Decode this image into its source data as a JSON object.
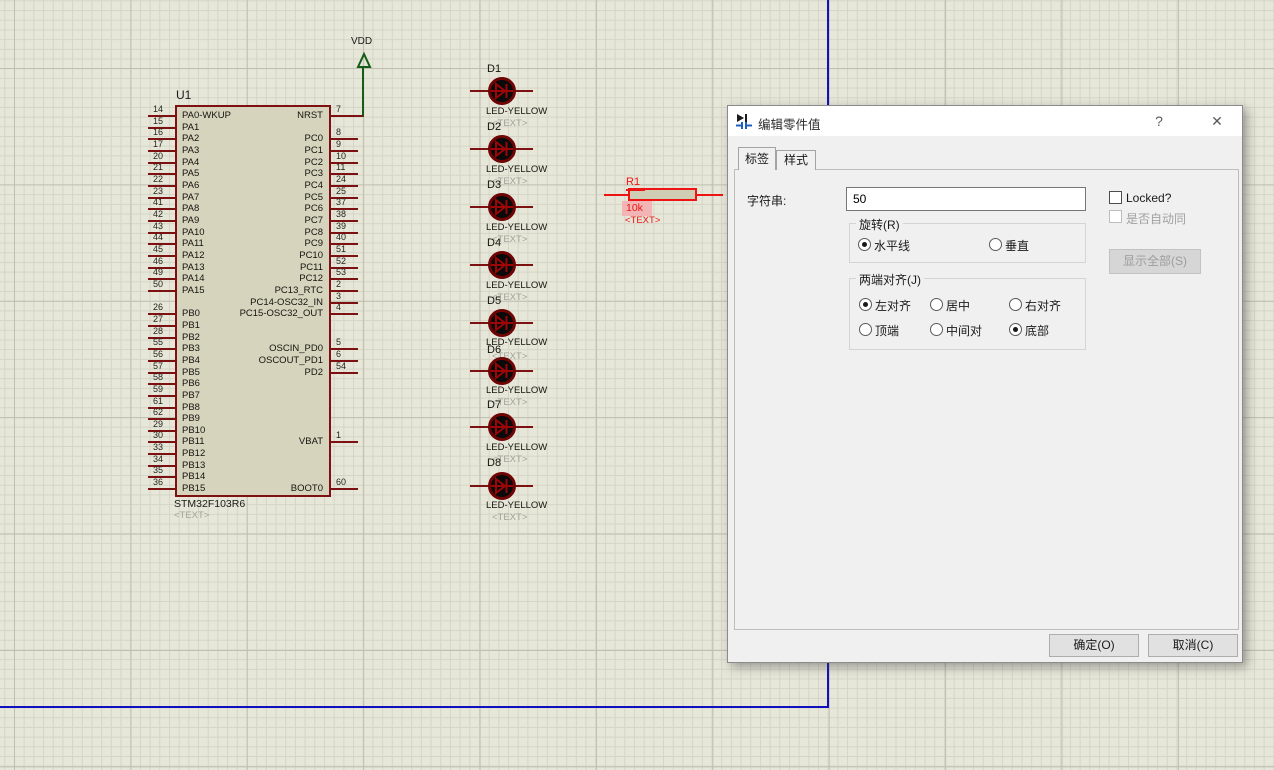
{
  "colors": {
    "grid-bg": "#e6e6d9",
    "grid-minor": "#d5d5c7",
    "grid-major": "#bfbfb1",
    "sheet": "#1010c0",
    "pin": "#7d1010",
    "chip-fill": "#d6d4bd",
    "select": "#ee1414",
    "wire": "#155c15",
    "led-ring": "#6e0404",
    "led-fill": "#0a0a0a",
    "text-ghost": "#a2a299",
    "dialog-bg": "#f0f0f0",
    "accent-disabled": "#9d9d9d"
  },
  "schematic": {
    "power": {
      "label": "VDD",
      "pin_number": "7"
    },
    "chip": {
      "ref": "U1",
      "part": "STM32F103R6",
      "text": "<TEXT>",
      "left_pins": [
        {
          "num": "14",
          "label": "PA0-WKUP",
          "row": 0
        },
        {
          "num": "15",
          "label": "PA1",
          "row": 1
        },
        {
          "num": "16",
          "label": "PA2",
          "row": 2
        },
        {
          "num": "17",
          "label": "PA3",
          "row": 3
        },
        {
          "num": "20",
          "label": "PA4",
          "row": 4
        },
        {
          "num": "21",
          "label": "PA5",
          "row": 5
        },
        {
          "num": "22",
          "label": "PA6",
          "row": 6
        },
        {
          "num": "23",
          "label": "PA7",
          "row": 7
        },
        {
          "num": "41",
          "label": "PA8",
          "row": 8
        },
        {
          "num": "42",
          "label": "PA9",
          "row": 9
        },
        {
          "num": "43",
          "label": "PA10",
          "row": 10
        },
        {
          "num": "44",
          "label": "PA11",
          "row": 11
        },
        {
          "num": "45",
          "label": "PA12",
          "row": 12
        },
        {
          "num": "46",
          "label": "PA13",
          "row": 13
        },
        {
          "num": "49",
          "label": "PA14",
          "row": 14
        },
        {
          "num": "50",
          "label": "PA15",
          "row": 15
        },
        {
          "num": "26",
          "label": "PB0",
          "row": 17
        },
        {
          "num": "27",
          "label": "PB1",
          "row": 18
        },
        {
          "num": "28",
          "label": "PB2",
          "row": 19
        },
        {
          "num": "55",
          "label": "PB3",
          "row": 20
        },
        {
          "num": "56",
          "label": "PB4",
          "row": 21
        },
        {
          "num": "57",
          "label": "PB5",
          "row": 22
        },
        {
          "num": "58",
          "label": "PB6",
          "row": 23
        },
        {
          "num": "59",
          "label": "PB7",
          "row": 24
        },
        {
          "num": "61",
          "label": "PB8",
          "row": 25
        },
        {
          "num": "62",
          "label": "PB9",
          "row": 26
        },
        {
          "num": "29",
          "label": "PB10",
          "row": 27
        },
        {
          "num": "30",
          "label": "PB11",
          "row": 28
        },
        {
          "num": "33",
          "label": "PB12",
          "row": 29
        },
        {
          "num": "34",
          "label": "PB13",
          "row": 30
        },
        {
          "num": "35",
          "label": "PB14",
          "row": 31
        },
        {
          "num": "36",
          "label": "PB15",
          "row": 32
        }
      ],
      "right_pins": [
        {
          "num": "7",
          "label": "NRST",
          "row": 0
        },
        {
          "num": "8",
          "label": "PC0",
          "row": 2
        },
        {
          "num": "9",
          "label": "PC1",
          "row": 3
        },
        {
          "num": "10",
          "label": "PC2",
          "row": 4
        },
        {
          "num": "11",
          "label": "PC3",
          "row": 5
        },
        {
          "num": "24",
          "label": "PC4",
          "row": 6
        },
        {
          "num": "25",
          "label": "PC5",
          "row": 7
        },
        {
          "num": "37",
          "label": "PC6",
          "row": 8
        },
        {
          "num": "38",
          "label": "PC7",
          "row": 9
        },
        {
          "num": "39",
          "label": "PC8",
          "row": 10
        },
        {
          "num": "40",
          "label": "PC9",
          "row": 11
        },
        {
          "num": "51",
          "label": "PC10",
          "row": 12
        },
        {
          "num": "52",
          "label": "PC11",
          "row": 13
        },
        {
          "num": "53",
          "label": "PC12",
          "row": 14
        },
        {
          "num": "2",
          "label": "PC13_RTC",
          "row": 15
        },
        {
          "num": "3",
          "label": "PC14-OSC32_IN",
          "row": 16
        },
        {
          "num": "4",
          "label": "PC15-OSC32_OUT",
          "row": 17
        },
        {
          "num": "5",
          "label": "OSCIN_PD0",
          "row": 20
        },
        {
          "num": "6",
          "label": "OSCOUT_PD1",
          "row": 21
        },
        {
          "num": "54",
          "label": "PD2",
          "row": 22
        },
        {
          "num": "1",
          "label": "VBAT",
          "row": 28
        },
        {
          "num": "60",
          "label": "BOOT0",
          "row": 32
        }
      ]
    },
    "leds": [
      {
        "ref": "D1",
        "type": "LED-YELLOW",
        "text": "<TEXT>",
        "label_y": 63,
        "led_y": 91,
        "type_y": 106,
        "text_y": 118
      },
      {
        "ref": "D2",
        "type": "LED-YELLOW",
        "text": "<TEXT>",
        "label_y": 121,
        "led_y": 149,
        "type_y": 164,
        "text_y": 176
      },
      {
        "ref": "D3",
        "type": "LED-YELLOW",
        "text": "<TEXT>",
        "label_y": 179,
        "led_y": 207,
        "type_y": 222,
        "text_y": 234
      },
      {
        "ref": "D4",
        "type": "LED-YELLOW",
        "text": "<TEXT>",
        "label_y": 237,
        "led_y": 265,
        "type_y": 280,
        "text_y": 292
      },
      {
        "ref": "D5",
        "type": "LED-YELLOW",
        "text": "<TEXT>",
        "label_y": 295,
        "led_y": 323,
        "type_y": 337,
        "text_y": 351
      },
      {
        "ref": "D6",
        "type": "LED-YELLOW",
        "text": "<TEXT>",
        "label_y": 344,
        "led_y": 371,
        "type_y": 385,
        "text_y": 397
      },
      {
        "ref": "D7",
        "type": "LED-YELLOW",
        "text": "<TEXT>",
        "label_y": 399,
        "led_y": 427,
        "type_y": 442,
        "text_y": 454
      },
      {
        "ref": "D8",
        "type": "LED-YELLOW",
        "text": "<TEXT>",
        "label_y": 457,
        "led_y": 486,
        "type_y": 500,
        "text_y": 512
      }
    ],
    "resistor": {
      "ref": "R1",
      "value": "10k",
      "text": "<TEXT>"
    }
  },
  "dialog": {
    "title": "编辑零件值",
    "help_glyph": "?",
    "close_glyph": "✕",
    "tabs": [
      {
        "label": "标签",
        "active": true
      },
      {
        "label": "样式",
        "active": false
      }
    ],
    "field_label": "字符串:",
    "field_value": "50",
    "locked_label": "Locked?",
    "auto_label": "是否自动同",
    "show_all_label": "显示全部(S)",
    "rotation": {
      "title": "旋转(R)",
      "options": [
        {
          "label": "水平线",
          "selected": true
        },
        {
          "label": "垂直",
          "selected": false
        }
      ]
    },
    "justify": {
      "title": "两端对齐(J)",
      "row1": [
        {
          "label": "左对齐",
          "selected": true
        },
        {
          "label": "居中",
          "selected": false
        },
        {
          "label": "右对齐",
          "selected": false
        }
      ],
      "row2": [
        {
          "label": "顶端",
          "selected": false
        },
        {
          "label": "中间对",
          "selected": false
        },
        {
          "label": "底部",
          "selected": true
        }
      ]
    },
    "ok_label": "确定(O)",
    "cancel_label": "取消(C)"
  }
}
